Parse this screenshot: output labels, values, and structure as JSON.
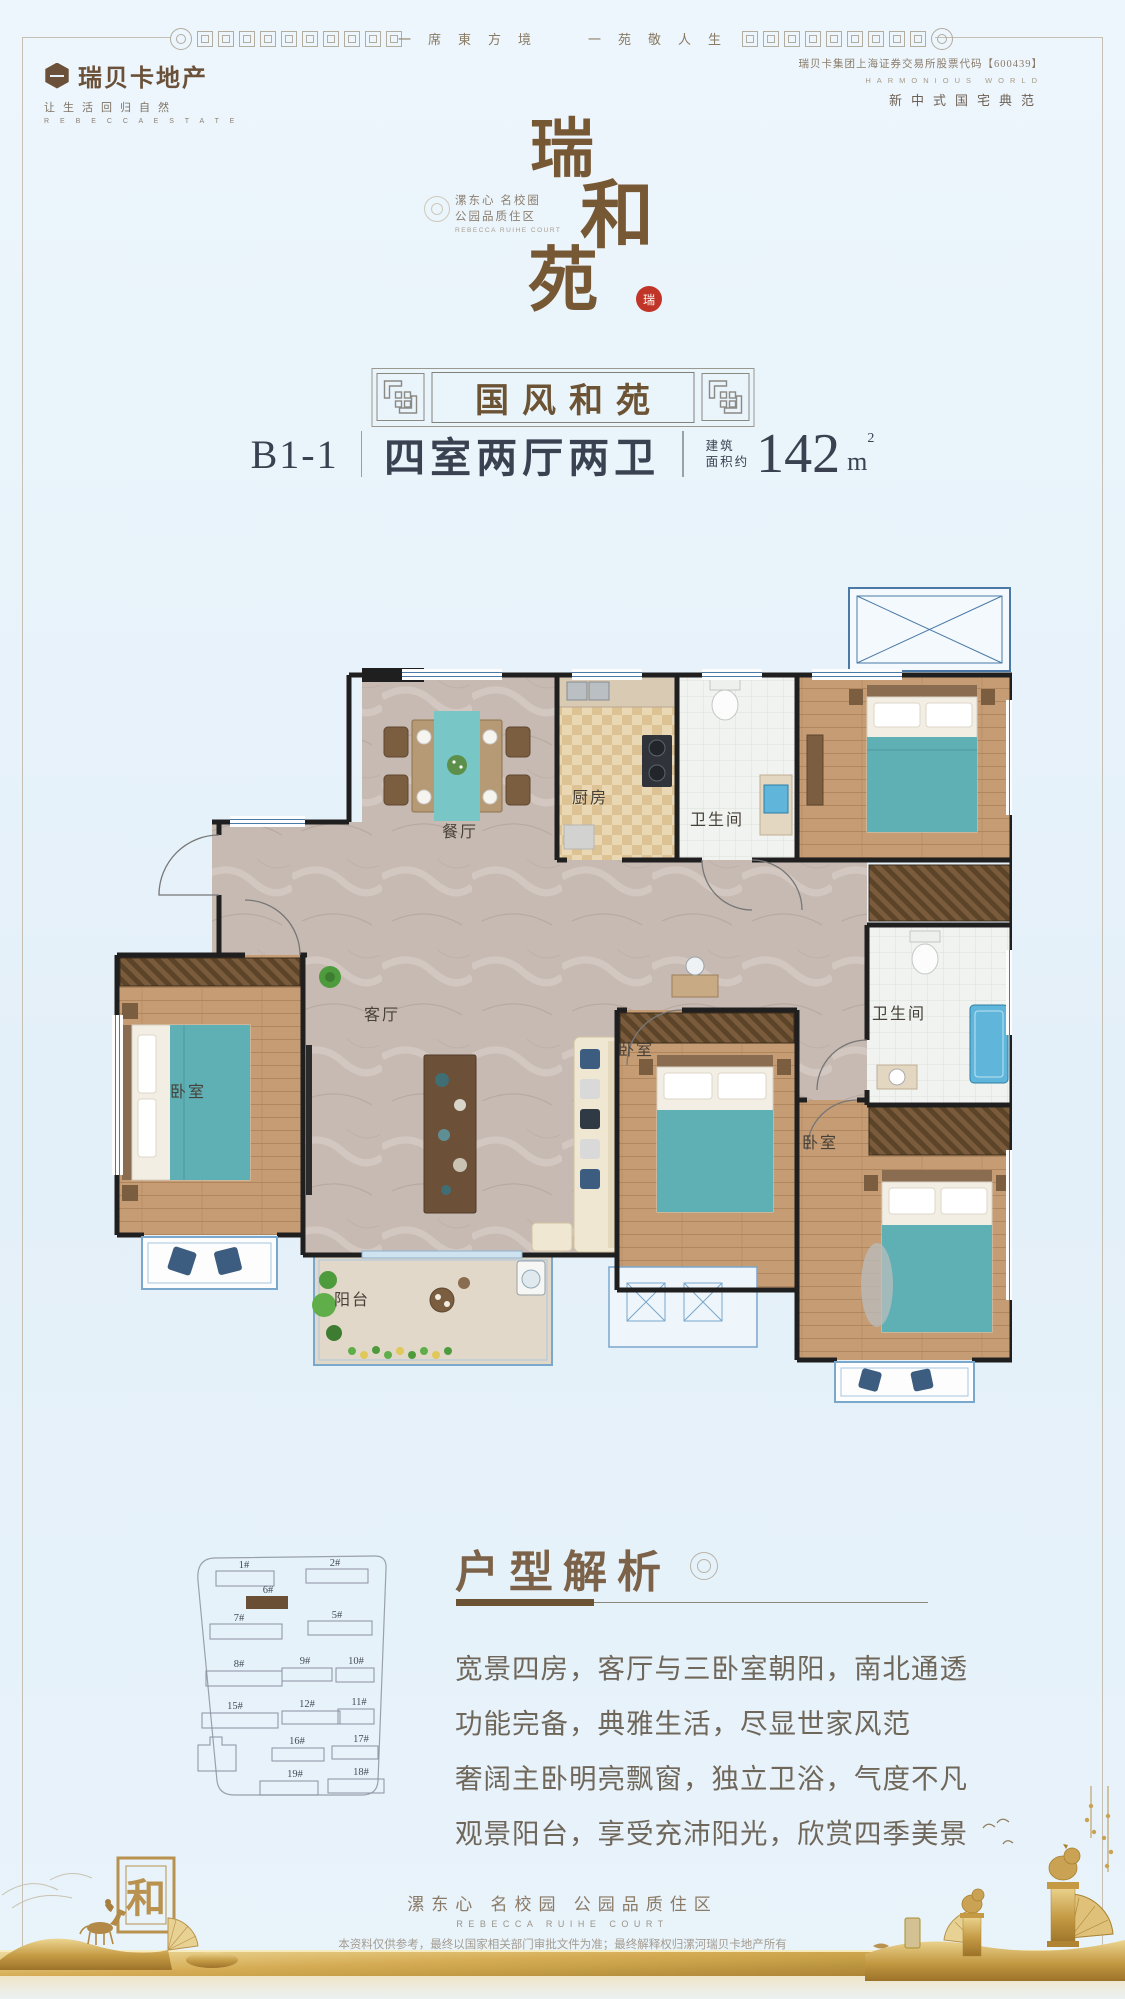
{
  "frame": {
    "motto_left": "一席東方境",
    "motto_right": "一苑敬人生"
  },
  "publisher": {
    "name": "瑞贝卡地产",
    "tagline": "让生活回归自然",
    "name_en": "R E B E C C A  E S T A T E"
  },
  "listing_info": {
    "stock": "瑞贝卡集团上海证券交易所股票代码【600439】",
    "world_en": "HARMONIOUS WORLD",
    "positioning": "新中式国宅典范"
  },
  "brand": {
    "char1": "瑞",
    "char2": "和",
    "char3": "苑",
    "seal": "瑞",
    "slogan_line1": "漯东心 名校圈",
    "slogan_line2": "公园品质住区",
    "slogan_en": "REBECCA RUIHE COURT"
  },
  "unit": {
    "series": "国风和苑",
    "code": "B1-1",
    "rooms": "四室两厅两卫",
    "area_label1": "建筑",
    "area_label2": "面积约",
    "area_number": "142",
    "area_unit": "m",
    "area_sup": "2"
  },
  "floorplan": {
    "dining": "餐厅",
    "kitchen": "厨房",
    "bath_top": "卫生间",
    "bath_right": "卫生间",
    "living": "客厅",
    "bedroom_left": "卧室",
    "bedroom_center": "卧室",
    "bedroom_right": "卧室",
    "balcony": "阳台"
  },
  "siteplan": {
    "buildings": [
      "1#",
      "2#",
      "6#",
      "7#",
      "5#",
      "8#",
      "9#",
      "10#",
      "15#",
      "12#",
      "11#",
      "16#",
      "17#",
      "19#",
      "18#"
    ],
    "highlighted": "6#"
  },
  "analysis": {
    "title": "户型解析",
    "line1": "宽景四房，客厅与三卧室朝阳，南北通透",
    "line2": "功能完备，典雅生活，尽显世家风范",
    "line3": "奢阔主卧明亮飘窗，独立卫浴，气度不凡",
    "line4": "观景阳台，享受充沛阳光，欣赏四季美景"
  },
  "footer": {
    "slogan": "漯东心 名校园 公园品质住区",
    "slogan_en": "REBECCA RUIHE COURT",
    "disclaimer": "本资料仅供参考，最终以国家相关部门审批文件为准；最终解释权归漯河瑞贝卡地产所有",
    "he": "和"
  }
}
